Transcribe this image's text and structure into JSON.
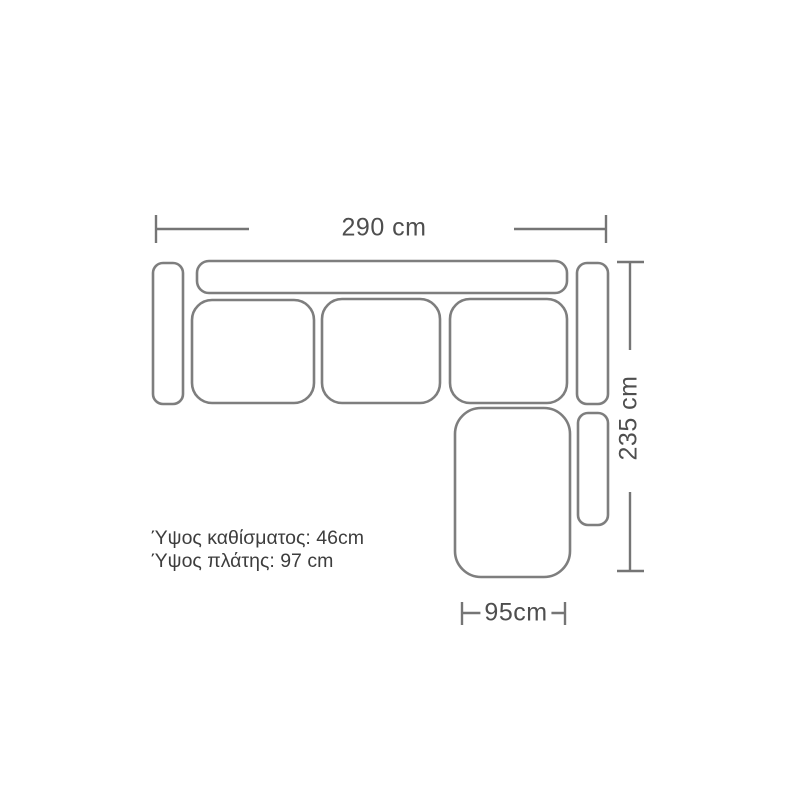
{
  "diagram": {
    "kind": "corner-sofa-top-view-floorplan",
    "dimensions": {
      "width": {
        "label": "290 cm",
        "value_cm": 290
      },
      "depth": {
        "label": "235 cm",
        "value_cm": 235
      },
      "chaise_width": {
        "label": "95cm",
        "value_cm": 95
      }
    },
    "notes": [
      "Ύψος καθίσματος: 46cm",
      "Ύψος πλάτης: 97 cm"
    ],
    "specs": {
      "seat_height": "46cm",
      "back_height": "97 cm"
    },
    "parts": [
      "left-armrest",
      "backrest",
      "seat-cushion-1",
      "seat-cushion-2",
      "seat-cushion-3",
      "right-backrest",
      "chaise-seat",
      "right-armrest"
    ],
    "colors": {
      "outline": "#7e7e7e",
      "dimension_line": "#757575",
      "label_text": "#4e4e4e",
      "note_text": "#3d3d3d",
      "background": "#ffffff"
    }
  }
}
